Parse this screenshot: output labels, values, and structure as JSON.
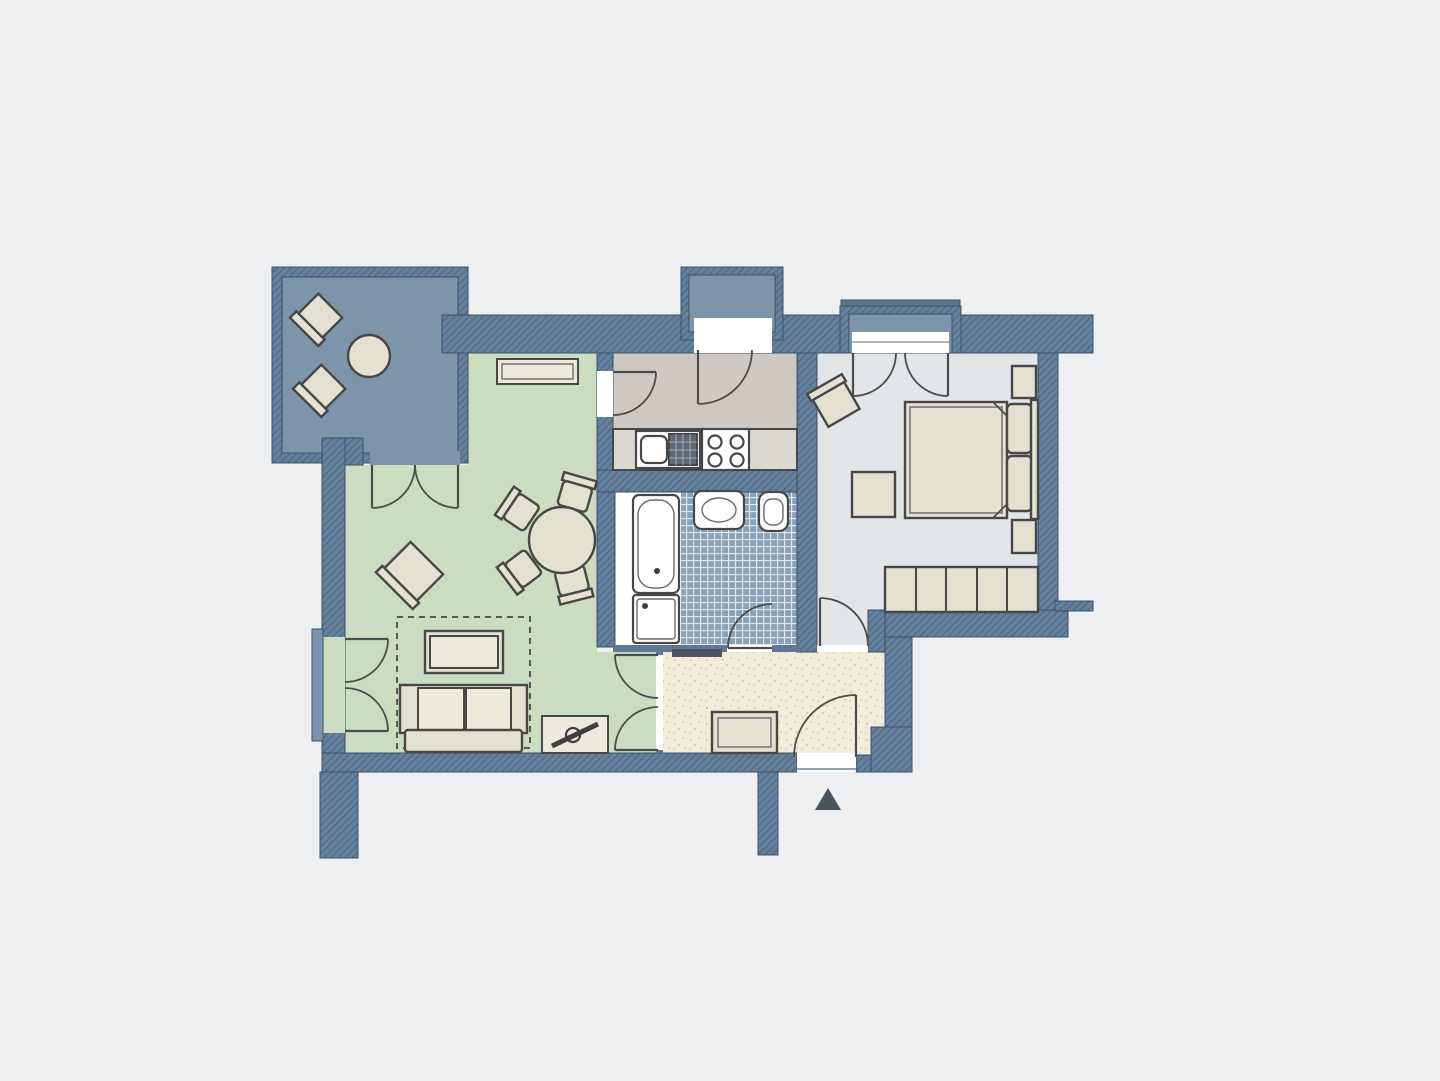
{
  "meta": {
    "title": "apartment-floor-plan",
    "type": "architectural-diagram",
    "has_text": false
  },
  "palette": {
    "bg": "#edeff1",
    "wall_base": "#63809c",
    "wall_hatch": "#49627c",
    "thin_wall": "#5d7890",
    "balcony_floor": "#7d95ab",
    "sill_dark": "#5d7588",
    "living_floor": "#cbdcc0",
    "kitchen_floor": "#d0c9c3",
    "counter": "#dbd7d1",
    "bath_tile": "#8ba3b7",
    "bath_tile_line": "#dfe8ee",
    "bedroom_floor": "#e3e6e9",
    "hall_floor": "#f2edda",
    "hall_speckle": "#cfc2a2",
    "fixture": "#ffffff",
    "opening": "#ffffff",
    "opening_line": "#93a2b0",
    "drainer": "#5f6a74",
    "drainer_line": "#9fb0ba",
    "accent": "#4a5462"
  },
  "rooms": [
    {
      "id": "balcony",
      "label": "balcony",
      "furniture": [
        "deck-chair",
        "deck-chair",
        "round-table"
      ]
    },
    {
      "id": "living-room",
      "label": "living-room",
      "furniture": [
        "wall-shelf",
        "dining-table",
        "dining-chair",
        "dining-chair",
        "dining-chair",
        "dining-chair",
        "armchair",
        "rug",
        "coffee-table",
        "sofa",
        "tv-sideboard"
      ]
    },
    {
      "id": "kitchen",
      "label": "kitchen",
      "furniture": [
        "counter",
        "sink-basin",
        "drainer",
        "stove"
      ]
    },
    {
      "id": "bathroom",
      "label": "bathroom",
      "furniture": [
        "bathtub",
        "shower",
        "washbasin",
        "toilet"
      ]
    },
    {
      "id": "bedroom",
      "label": "bedroom",
      "furniture": [
        "double-bed",
        "pillow",
        "pillow",
        "nightstand",
        "nightstand",
        "wardrobe",
        "chair",
        "bench"
      ]
    },
    {
      "id": "hallway",
      "label": "hallway",
      "furniture": [
        "cabinet",
        "doormat"
      ]
    }
  ],
  "entrance": {
    "symbol": "up-arrow",
    "color": "#49525f"
  }
}
